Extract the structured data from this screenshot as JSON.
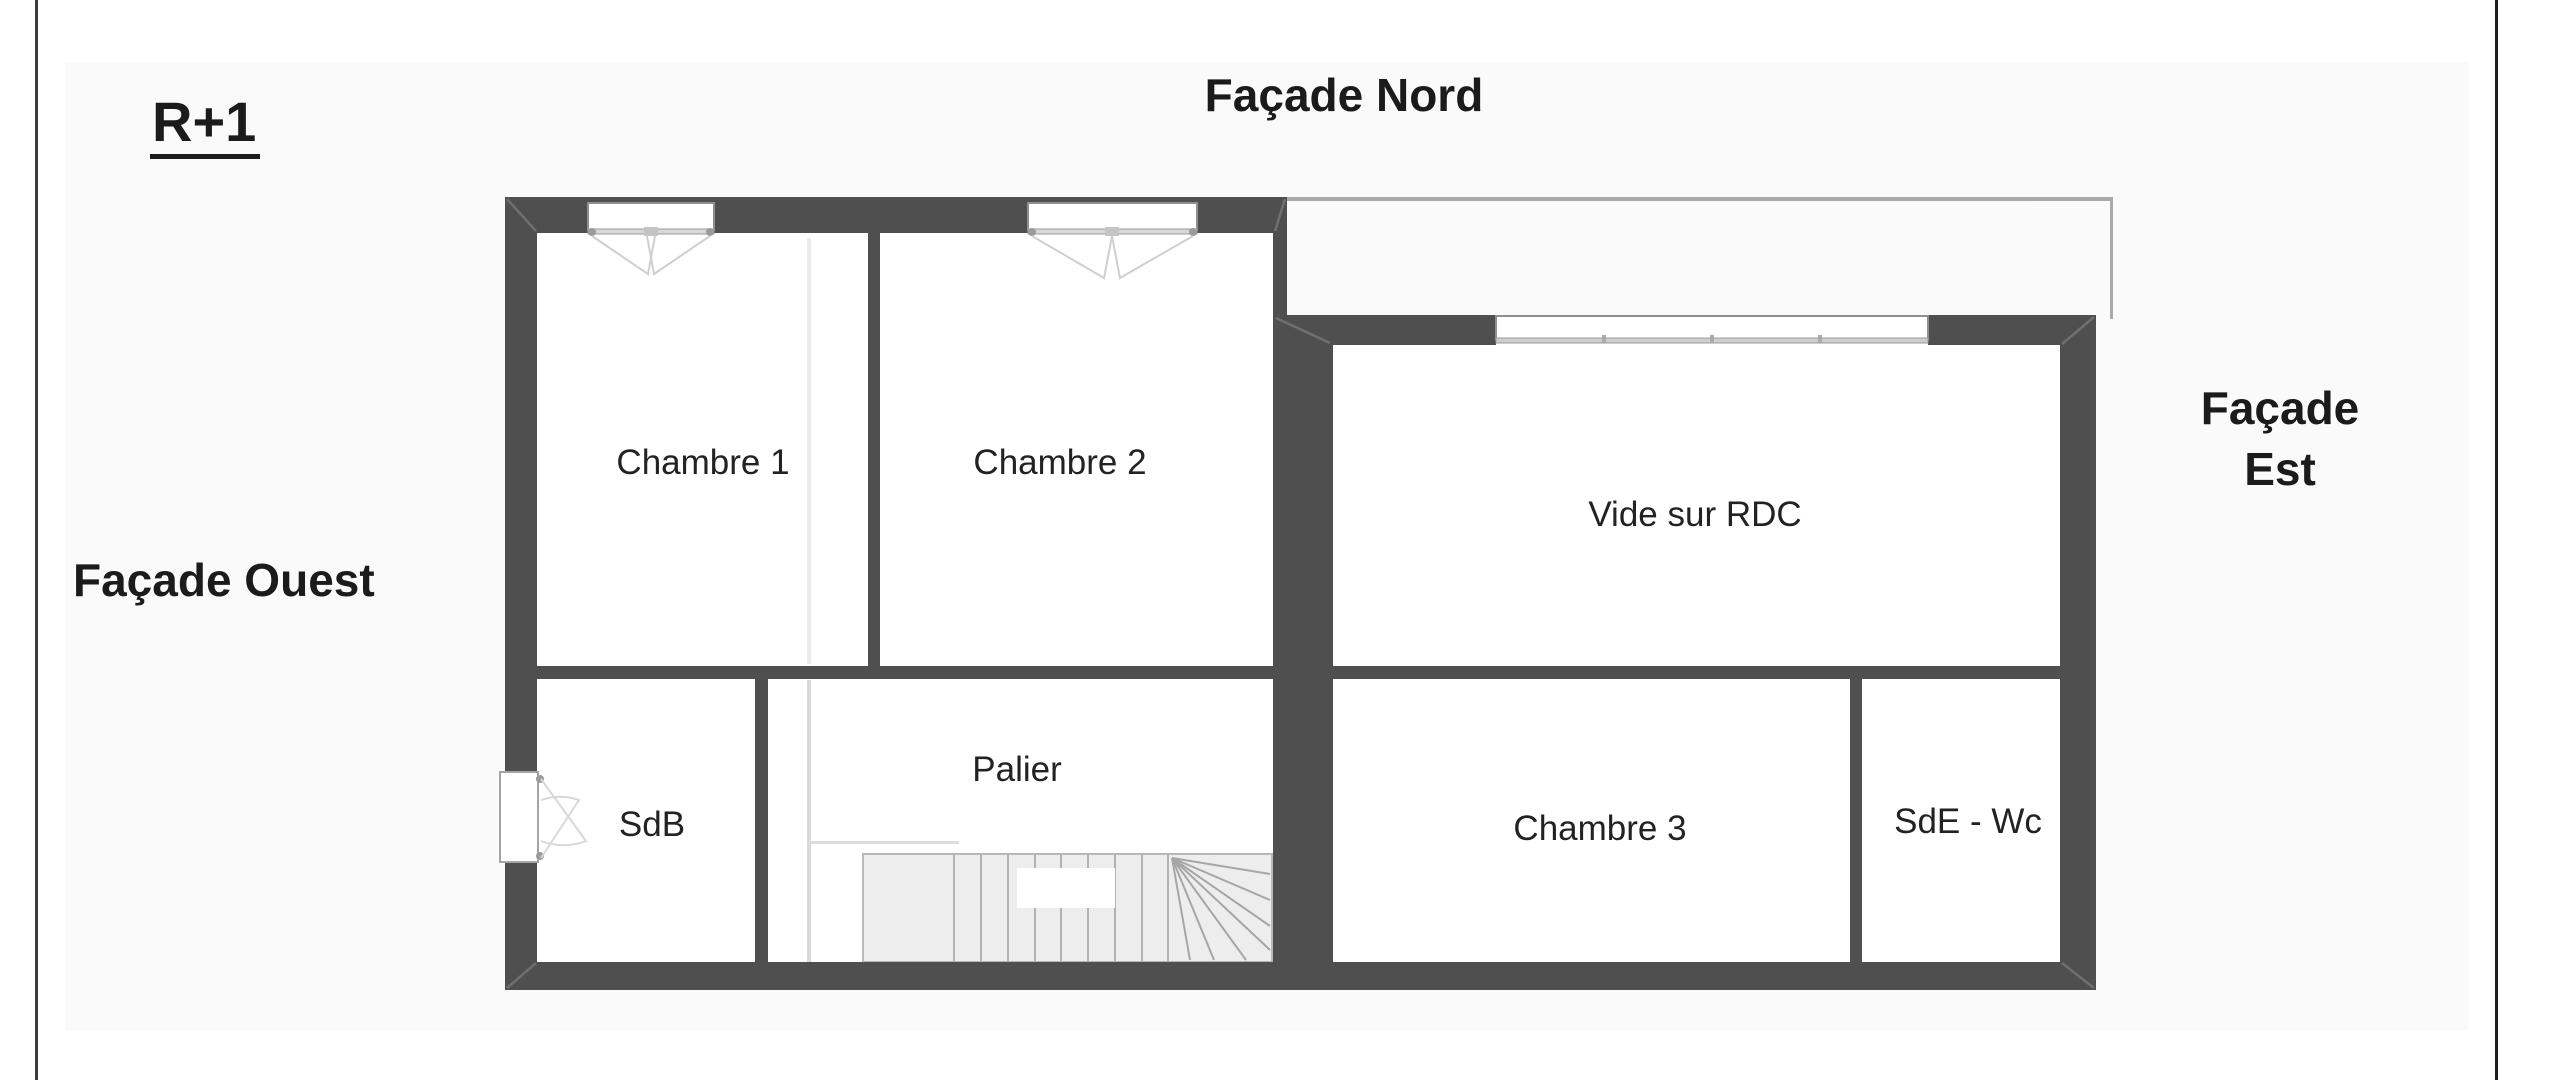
{
  "labels": {
    "floor": "R+1",
    "facade_north": "Façade Nord",
    "facade_west": "Façade Ouest",
    "facade_east_line1": "Façade",
    "facade_east_line2": "Est"
  },
  "rooms": {
    "chambre1": "Chambre 1",
    "chambre2": "Chambre 2",
    "vide": "Vide sur RDC",
    "sdb": "SdB",
    "palier": "Palier",
    "chambre3": "Chambre 3",
    "sde_wc": "SdE - Wc"
  },
  "colors": {
    "wall": "#4f4f4f",
    "plan_floor": "#ffffff",
    "page_panel": "#fafafa",
    "stair_fill": "#ededed",
    "stair_lines": "#b2b2b2",
    "swing_lines": "#cfcfcf",
    "text": "#1b1b1b"
  }
}
